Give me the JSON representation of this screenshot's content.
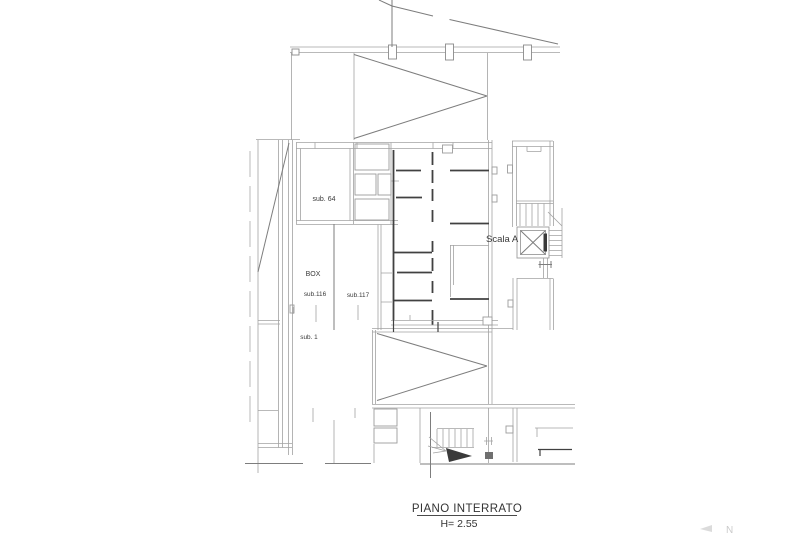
{
  "page": {
    "background": "#ffffff"
  },
  "title_block": {
    "title": "PIANO INTERRATO",
    "height_note": "H= 2.55"
  },
  "labels": {
    "sub_64": "sub. 64",
    "box": "BOX",
    "sub_116": "sub.116",
    "sub_117": "sub.117",
    "sub_1": "sub. 1",
    "scala_a": "Scala A",
    "corner_mark": "N"
  },
  "colors": {
    "background": "#ffffff",
    "line_light": "#a2a2a2",
    "line_medium": "#7d7d7d",
    "line_dark": "#414141",
    "text": "#3a3a3a"
  }
}
